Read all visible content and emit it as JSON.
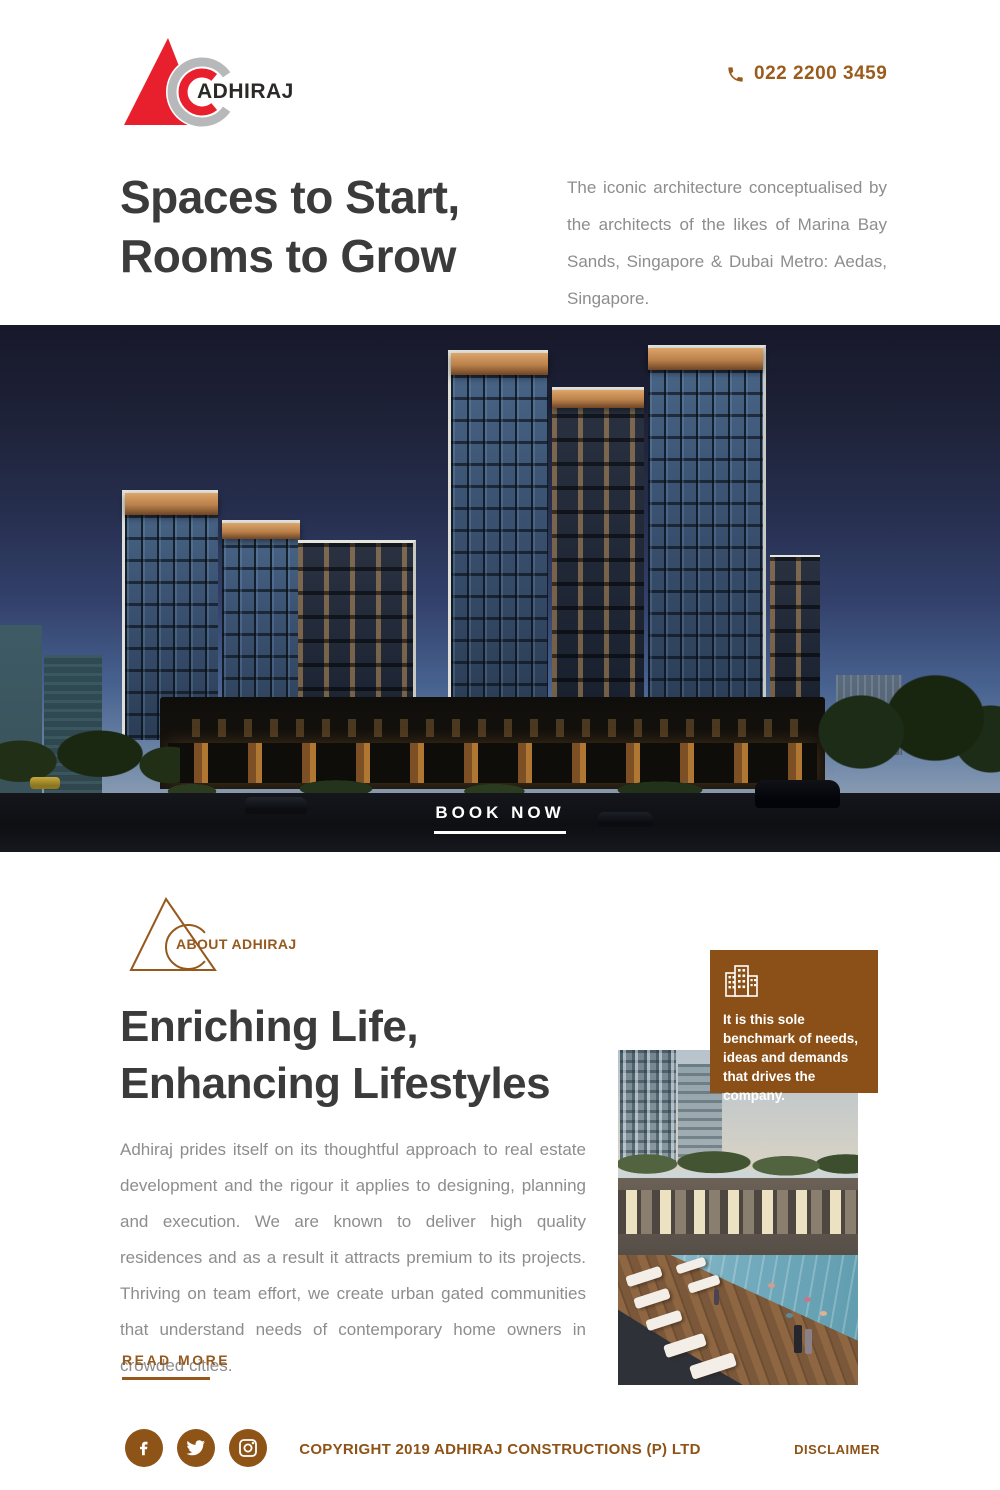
{
  "theme": {
    "accent_brown": "#8D5317",
    "accent_text_brown": "#96591D",
    "logo_red": "#E8202E",
    "logo_ring_gray": "#B7B8BA",
    "heading_color": "#3B3B3B",
    "body_text_color": "#8D8D8D"
  },
  "header": {
    "brand": "ADHIRAJ",
    "phone": "022 2200 3459"
  },
  "hero": {
    "title_line1": "Spaces to Start,",
    "title_line2": "Rooms to Grow",
    "description": "The iconic architecture conceptualised by the architects of the likes of Marina Bay Sands, Singapore & Dubai Metro: Aedas, Singapore.",
    "cta_label": "BOOK NOW"
  },
  "about": {
    "section_label": "ABOUT ADHIRAJ",
    "title_line1": "Enriching Life,",
    "title_line2": "Enhancing Lifestyles",
    "body": "Adhiraj prides itself on its thoughtful approach to real estate development and the rigour it applies to designing, planning and execution. We are known to deliver high quality residences and as a result it attracts premium to its projects. Thriving on team effort, we create urban gated communities that understand needs of contemporary home owners in crowded cities.",
    "read_more_label": "READ MORE",
    "callout_text": "It is this sole benchmark of needs, ideas and demands that drives the company."
  },
  "footer": {
    "social_icons": [
      "facebook-icon",
      "twitter-icon",
      "instagram-icon"
    ],
    "copyright": "COPYRIGHT 2019 ADHIRAJ CONSTRUCTIONS (P) LTD",
    "disclaimer_label": "DISCLAIMER"
  }
}
